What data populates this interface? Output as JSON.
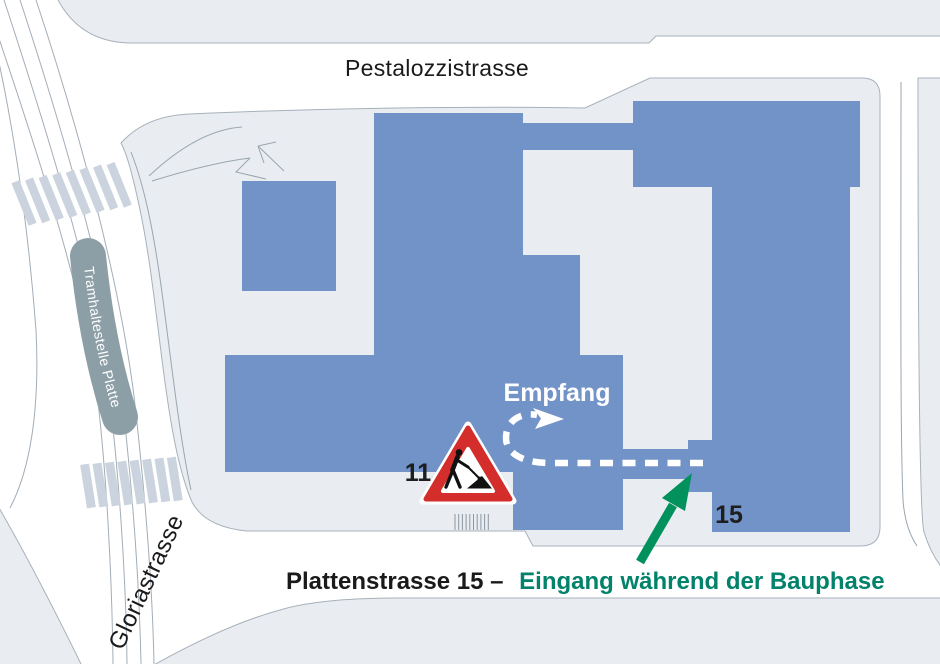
{
  "map": {
    "labels": {
      "street_top": "Pestalozzistrasse",
      "street_left": "Gloriastrasse",
      "tram_stop": "Tramhaltestelle Platte",
      "reception": "Empfang",
      "building_left_number": "11",
      "building_right_number": "15",
      "caption_black": "Plattenstrasse 15 –",
      "caption_green": "Eingang während der Bauphase"
    },
    "colors": {
      "building_fill": "#7293C8",
      "parcel_fill": "#E9EDF1",
      "street_fill": "#FFFFFF",
      "crosswalk_stripe": "#CBD4DE",
      "tram_stop_pill": "#8C9FA7",
      "route_dash": "#FFFFFF",
      "entrance_arrow_green": "#00915C",
      "caption_green": "#00826B",
      "caption_black": "#1A1A1A",
      "construction_sign_red": "#D42E2C"
    }
  }
}
